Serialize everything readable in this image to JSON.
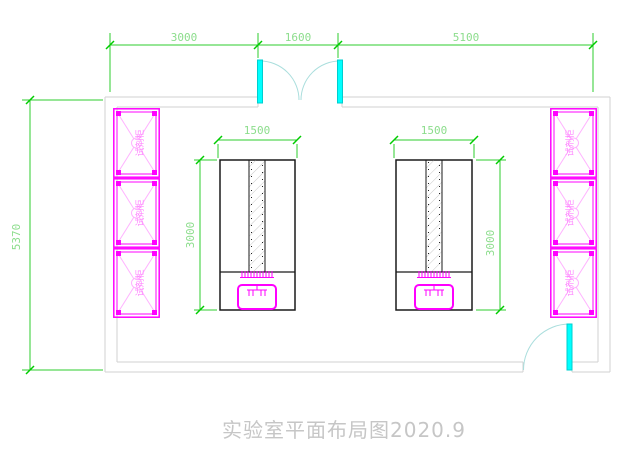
{
  "drawing": {
    "title": "实验室平面布局图2020.9"
  },
  "dimensions": {
    "top": [
      "3000",
      "1600",
      "5100"
    ],
    "left_wall": "5370",
    "bench_width": "1500",
    "bench_depth": "3000"
  },
  "cabinets": {
    "label": "试剂柜",
    "count_left": 3,
    "count_right": 3
  },
  "colors": {
    "dimension_line": "#2ecc2e",
    "dimension_text": "#8cdd8c",
    "cabinet": "#ff00ff",
    "cabinet_hatch": "#ffb3ff",
    "door_leaf": "#00ffff",
    "door_arc": "#aadedd",
    "wall": "#d2d2d2",
    "bench_outline": "#1a1a1a",
    "title_text": "#c6c6c6"
  }
}
